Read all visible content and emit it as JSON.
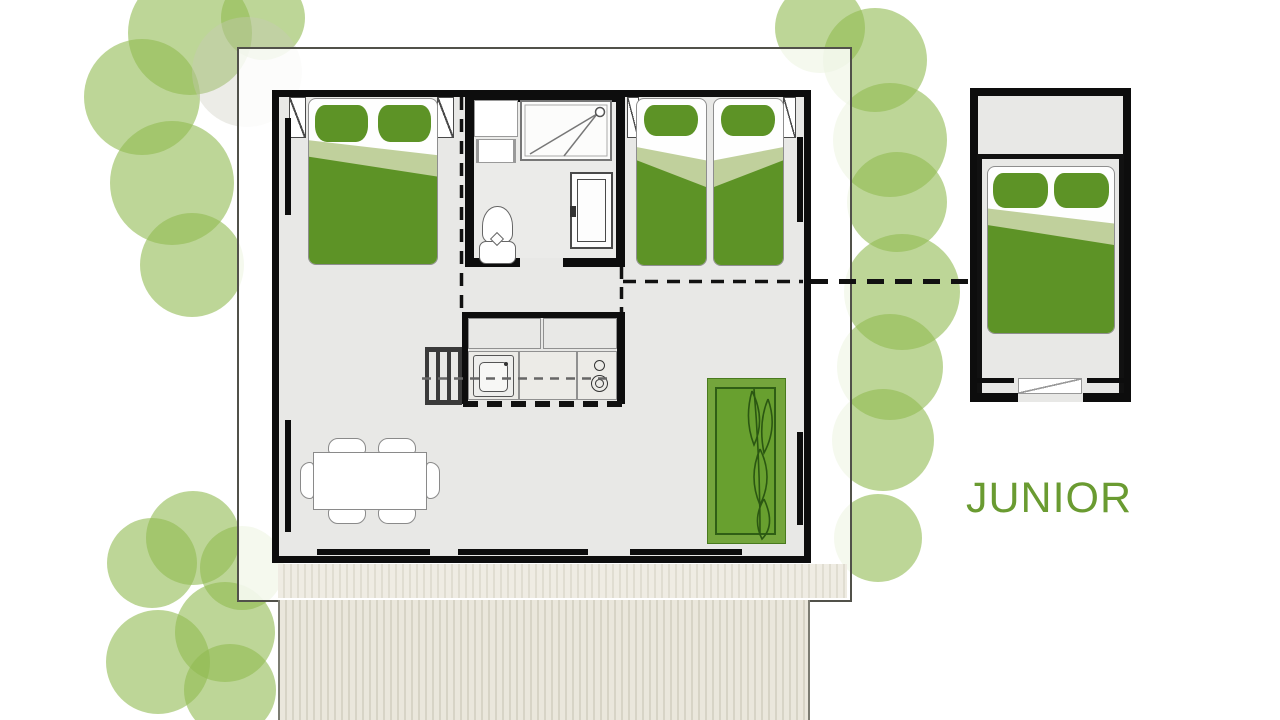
{
  "plan": {
    "unit_label": "JUNIOR",
    "rooms": {
      "main_bedrooms": 2,
      "bathroom": 1,
      "living_kitchen": 1,
      "annex_junior_bedroom": 1
    },
    "furniture_icons": [
      "double-bed",
      "single-bed",
      "single-bed",
      "junior-double-bed",
      "shower",
      "toilet",
      "washbasin-cabinet",
      "bathroom-door",
      "kitchen-cabinets",
      "kitchen-sink",
      "stove",
      "ladder",
      "dining-table",
      "dining-chair",
      "dining-chair",
      "dining-chair",
      "dining-chair",
      "dining-chair",
      "dining-chair",
      "sofa",
      "terrace-deck",
      "entrance-step",
      "window",
      "tree-canopy"
    ],
    "dining_chair_count": 6
  },
  "colors": {
    "tree_green": "#91ba52",
    "bed_green_dark": "#5d9326",
    "bed_green_light": "#c0d09c",
    "sofa_green": "#74a53c",
    "sofa_leaf_dark": "#2b5712",
    "label_green": "#6a9b31",
    "wall_black": "#0d0d0d",
    "floor_gray": "#e8e8e6",
    "deck_beige": "#e0ddd1",
    "plot_border": "#51514a"
  }
}
